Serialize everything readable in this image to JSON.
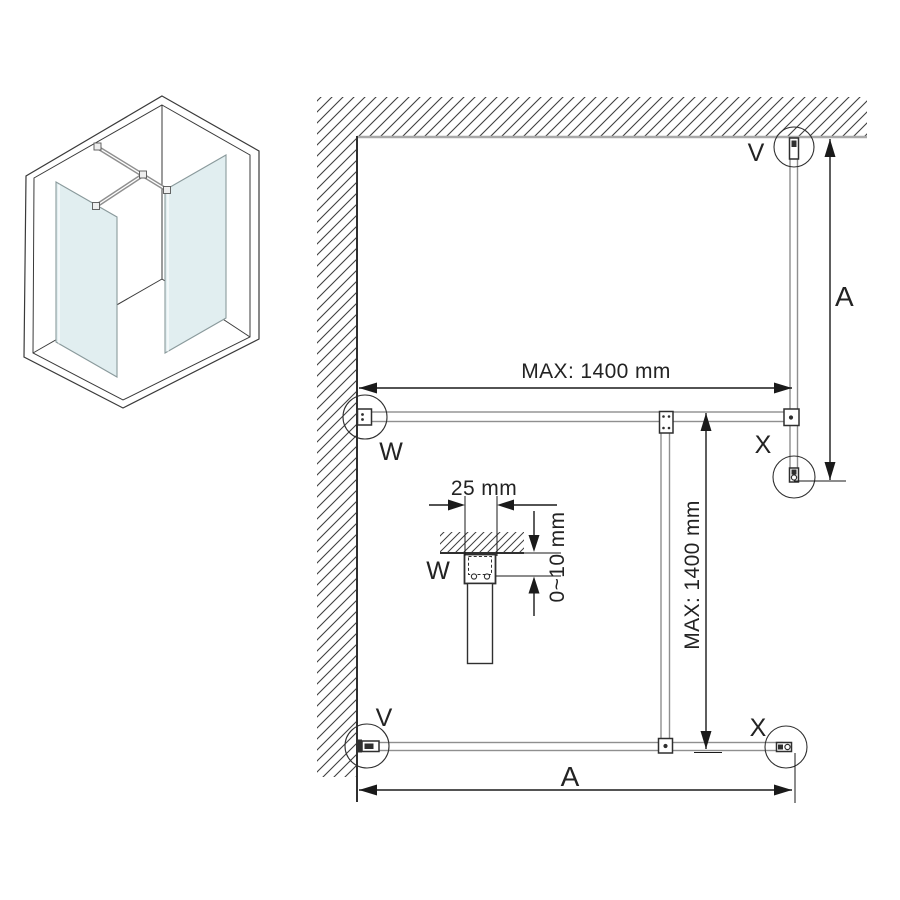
{
  "diagram": {
    "labels": {
      "v_top": "V",
      "v_bottom": "V",
      "w_wall": "W",
      "w_detail": "W",
      "x_right": "X",
      "x_bottom": "X"
    },
    "dimensions": {
      "max_width": "MAX: 1400 mm",
      "max_depth": "MAX: 1400 mm",
      "a_right": "A",
      "a_bottom": "A",
      "bracket_width": "25 mm",
      "wall_gap": "0~10 mm"
    },
    "icons": {
      "isometric_preview": "shower-enclosure-3d-icon",
      "wall_hatch": "wall-section-hatch",
      "highlight_circles": "callout-circle"
    },
    "colors": {
      "glass": "#e1eef0",
      "dimension_line": "#1a1a1a",
      "wall_line": "#a9a9a9",
      "hardware_line": "#8f8f8f",
      "background": "#ffffff"
    }
  }
}
